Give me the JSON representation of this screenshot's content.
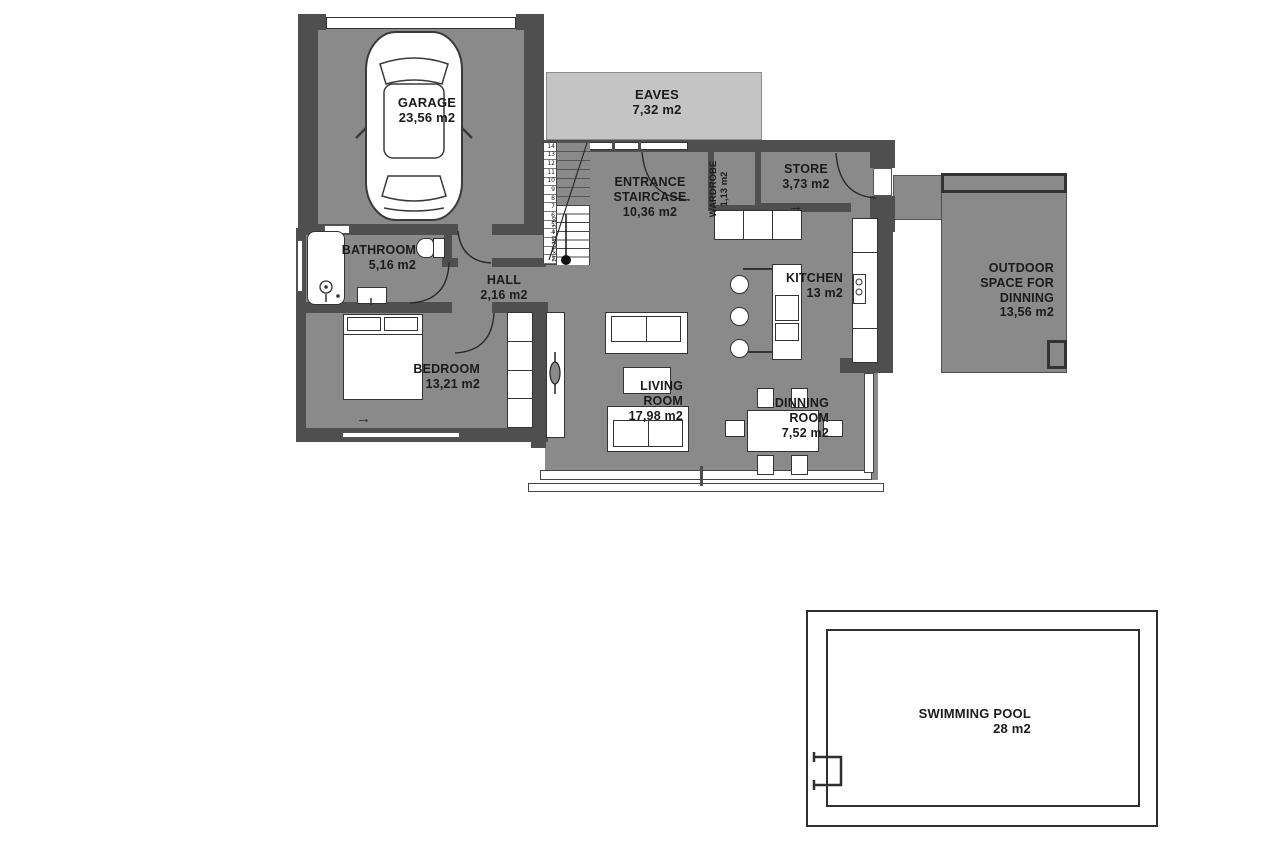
{
  "rooms": {
    "garage": {
      "name": "GARAGE",
      "area": "23,56 m2"
    },
    "eaves": {
      "name": "EAVES",
      "area": "7,32 m2"
    },
    "entrance": {
      "name": [
        "ENTRANCE",
        "STAIRCASE"
      ],
      "area": "10,36 m2"
    },
    "wardrobe": {
      "name": "WARDROBE",
      "area": "1,13 m2"
    },
    "store": {
      "name": "STORE",
      "area": "3,73 m2"
    },
    "outdoor": {
      "name": [
        "OUTDOOR",
        "SPACE FOR",
        "DINNING"
      ],
      "area": "13,56 m2"
    },
    "bathroom": {
      "name": "BATHROOM",
      "area": "5,16 m2"
    },
    "hall": {
      "name": "HALL",
      "area": "2,16 m2"
    },
    "kitchen": {
      "name": "KITCHEN",
      "area": "13 m2"
    },
    "bedroom": {
      "name": "BEDROOM",
      "area": "13,21 m2"
    },
    "living": {
      "name": [
        "LIVING",
        "ROOM"
      ],
      "area": "17,98 m2"
    },
    "dinning": {
      "name": [
        "DINNING",
        "ROOM"
      ],
      "area": "7,52 m2"
    },
    "pool": {
      "name": "SWIMMING POOL",
      "area": "28 m2"
    }
  },
  "stairs": {
    "numbers": [
      "14",
      "13",
      "12",
      "11",
      "10",
      "9",
      "8",
      "7",
      "6",
      "5",
      "4",
      "3",
      "2",
      "1"
    ],
    "formula": "14 x 0,221 = 3,10"
  },
  "icons": {
    "arrow_right": "→"
  },
  "colors": {
    "wall": "#4f4f4f",
    "floor": "#8a8a8a",
    "eaves": "#c4c4c4",
    "line": "#333333"
  }
}
